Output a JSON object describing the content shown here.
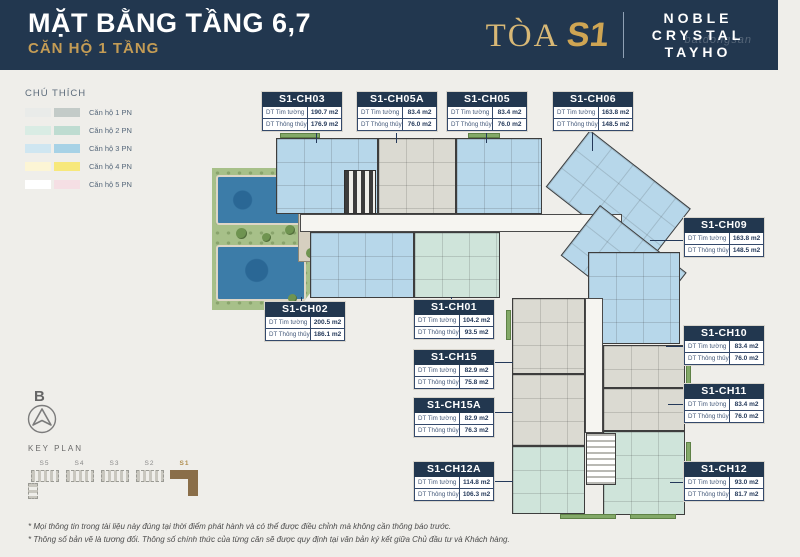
{
  "header": {
    "title": "MẶT BẰNG TẦNG 6,7",
    "subtitle": "CĂN HỘ 1 TẦNG",
    "tower_prefix": "TÒA",
    "tower_name": "S1",
    "brand": [
      "NOBLE",
      "CRYSTAL",
      "TAYHO"
    ],
    "watermark": "batdongsan"
  },
  "legend": {
    "title": "CHÚ THÍCH",
    "items": [
      {
        "label": "Căn hộ 1 PN",
        "light": "#e9ebe9",
        "dark": "#c3cbc8"
      },
      {
        "label": "Căn hộ 2 PN",
        "light": "#d9ece4",
        "dark": "#bedcd1"
      },
      {
        "label": "Căn hộ 3 PN",
        "light": "#cfe6f1",
        "dark": "#a7d2e6"
      },
      {
        "label": "Căn hộ 4 PN",
        "light": "#fcf5d5",
        "dark": "#f7e87b"
      },
      {
        "label": "Căn hộ 5 PN",
        "light": "#ffffff",
        "dark": "#f5dfe4"
      }
    ]
  },
  "labels": {
    "tim": "DT Tim tường",
    "thong": "DT Thông thủy"
  },
  "units": [
    {
      "name": "S1-CH03",
      "tim": "190.7 m2",
      "thong": "176.9 m2"
    },
    {
      "name": "S1-CH05A",
      "tim": "83.4 m2",
      "thong": "76.0 m2"
    },
    {
      "name": "S1-CH05",
      "tim": "83.4 m2",
      "thong": "76.0 m2"
    },
    {
      "name": "S1-CH06",
      "tim": "163.8 m2",
      "thong": "148.5 m2"
    },
    {
      "name": "S1-CH09",
      "tim": "163.8 m2",
      "thong": "148.5 m2"
    },
    {
      "name": "S1-CH10",
      "tim": "83.4 m2",
      "thong": "76.0 m2"
    },
    {
      "name": "S1-CH11",
      "tim": "83.4 m2",
      "thong": "76.0 m2"
    },
    {
      "name": "S1-CH12",
      "tim": "93.0 m2",
      "thong": "81.7 m2"
    },
    {
      "name": "S1-CH02",
      "tim": "200.5 m2",
      "thong": "186.1 m2"
    },
    {
      "name": "S1-CH01",
      "tim": "104.2 m2",
      "thong": "93.5 m2"
    },
    {
      "name": "S1-CH15",
      "tim": "82.9 m2",
      "thong": "75.8 m2"
    },
    {
      "name": "S1-CH15A",
      "tim": "82.9 m2",
      "thong": "76.3 m2"
    },
    {
      "name": "S1-CH12A",
      "tim": "114.8 m2",
      "thong": "106.3 m2"
    }
  ],
  "keyplan": {
    "compass_letter": "B",
    "title": "KEY PLAN",
    "buildings": [
      {
        "label": "S5"
      },
      {
        "label": "S4"
      },
      {
        "label": "S3"
      },
      {
        "label": "S2"
      },
      {
        "label": "S1"
      }
    ],
    "highlight_color": "#8a6e49"
  },
  "palette": {
    "navy": "#22374f",
    "gold": "#c49c55",
    "blue": "#b7d7ea",
    "gray": "#dbdad2",
    "teal": "#cfe4da",
    "pool": "#3c7ca8",
    "green": "#a7c089",
    "wall": "#3d3d3d"
  },
  "footnotes": [
    "* Mọi thông tin trong tài liệu này đúng tại thời điểm phát hành và có thể được điều chỉnh mà không cần thông báo trước.",
    "* Thông số bản vẽ là tương đối. Thông số chính thức của từng căn sẽ được quy định tại văn bản ký kết giữa Chủ đầu tư và Khách hàng."
  ]
}
